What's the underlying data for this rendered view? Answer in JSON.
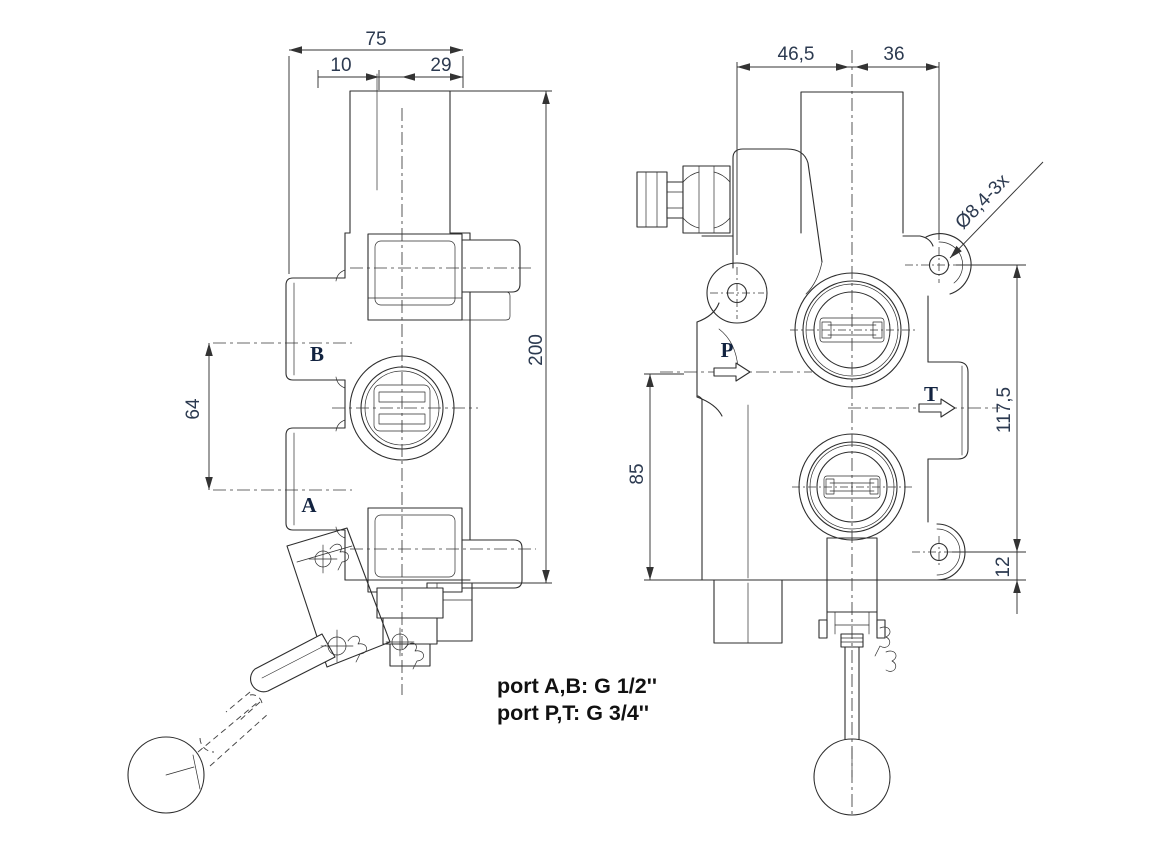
{
  "left_view": {
    "dim_overall_width": "75",
    "dim_lever_offset": "10",
    "dim_right_offset": "29",
    "dim_total_height": "200",
    "dim_port_spacing": "64",
    "label_port_b": "B",
    "label_port_a": "A"
  },
  "right_view": {
    "dim_width_left": "46,5",
    "dim_width_right": "36",
    "dim_mount_hole_spacing": "117,5",
    "dim_mount_hole_bottom": "12",
    "dim_inlet_height": "85",
    "callout_mount_holes": "Ø8,4-3x",
    "label_port_p": "P",
    "label_port_t": "T"
  },
  "notes": {
    "line1": "port A,B: G 1/2''",
    "line2": "port P,T: G 3/4''"
  },
  "colors": {
    "line": "#2e2e2e",
    "dimension_text": "#2c3a50",
    "port_label_text": "#122340",
    "note_text": "#111111",
    "background": "#ffffff"
  }
}
